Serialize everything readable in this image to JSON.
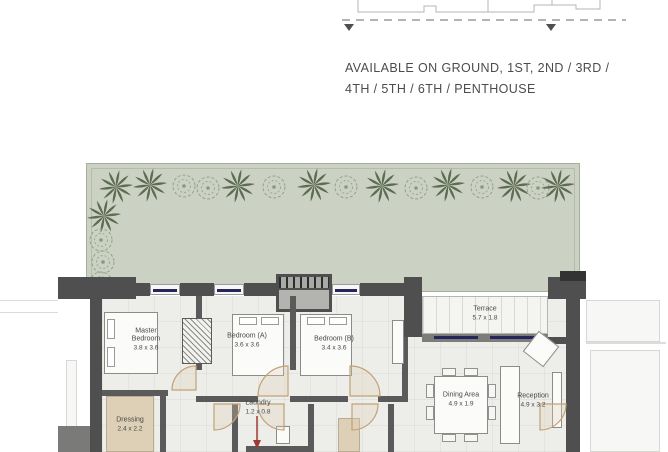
{
  "availability": {
    "line1": "AVAILABLE ON GROUND, 1ST, 2ND / 3RD /",
    "line2": "4TH / 5TH / 6TH / PENTHOUSE"
  },
  "floor_plan": {
    "rooms": {
      "master_bedroom": {
        "name": "Master Bedroom",
        "dims": "3.8 x 3.6"
      },
      "bedroom_a": {
        "name": "Bedroom (A)",
        "dims": "3.6 x 3.6"
      },
      "bedroom_b": {
        "name": "Bedroom (B)",
        "dims": "3.4 x 3.6"
      },
      "terrace": {
        "name": "Terrace",
        "dims": "5.7 x 1.8"
      },
      "dining_area": {
        "name": "Dining Area",
        "dims": "4.9 x 1.9"
      },
      "reception": {
        "name": "Reception",
        "dims": "4.9 x 3.2"
      },
      "dressing": {
        "name": "Dressing",
        "dims": "2.4 x 2.2"
      },
      "laundry": {
        "name": "Laundry",
        "dims": "1.2 x 0.8"
      }
    },
    "colors": {
      "garden_green": "#cbd2c3",
      "wall_gray": "#4f4f4f",
      "window_navy": "#26265c",
      "wood_beige": "#ddd0b6",
      "annotation_red": "#9e3a31"
    }
  }
}
